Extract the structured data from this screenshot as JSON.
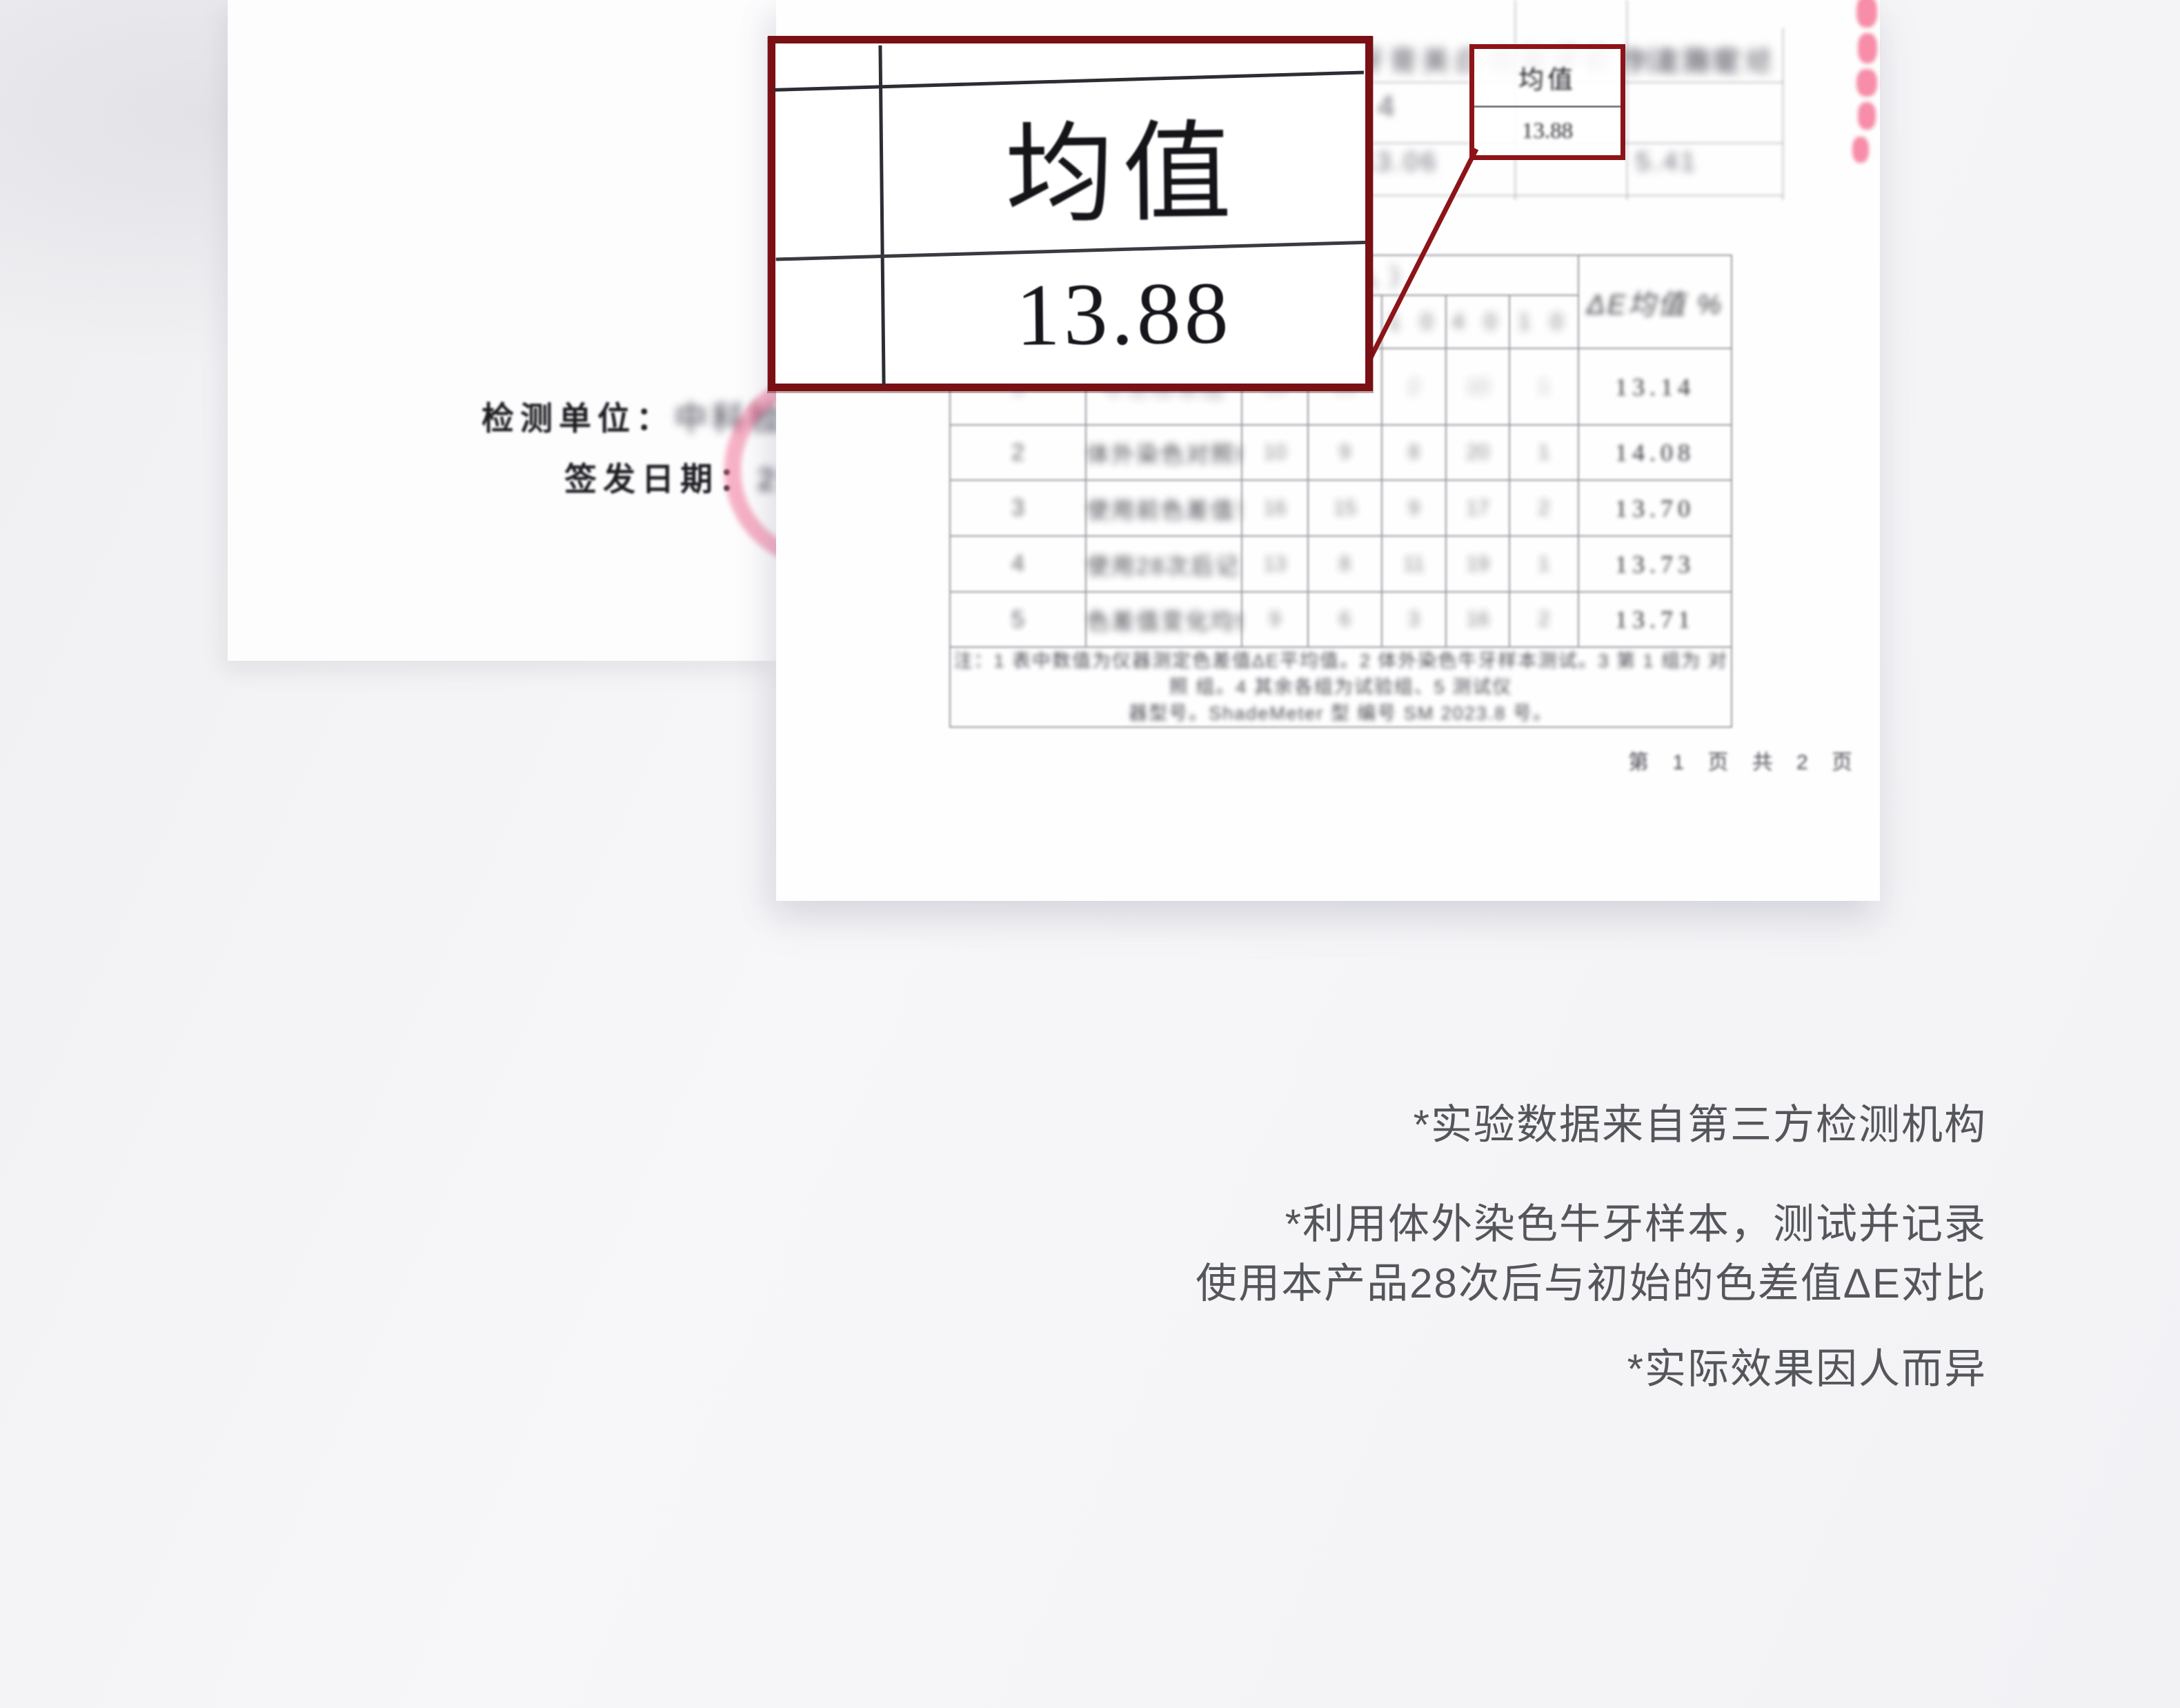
{
  "colors": {
    "accent_red": "#7a1014",
    "stamp_pink": "#f78da8",
    "disclaimer_text": "#54565b"
  },
  "callout": {
    "label": "均值",
    "value": "13.88",
    "mini": {
      "label": "均值",
      "value": "13.88"
    }
  },
  "back_paper": {
    "line1_label": "检测单位：",
    "line1_value": "中科检测",
    "line2_label": "签发日期：",
    "line2_value": "2023"
  },
  "report": {
    "title_blur": "依据企业标准牙膏美白功效评价方法测定结果 3.2",
    "ghost": {
      "cell_a": "4",
      "cell_b": "13.06",
      "header": "判定指标",
      "cell_c": "5.41"
    },
    "table": {
      "group_header": "测试数据（测试人）",
      "sub_headers": [
        "3 0",
        "1 0",
        "4 0",
        "1 0"
      ],
      "right_header": "ΔE均值 %",
      "rows": [
        {
          "cells": [
            "1",
            "牛牙样本组",
            "13",
            "13",
            "2",
            "10",
            "1",
            "13.14"
          ]
        },
        {
          "cells": [
            "2",
            "体外染色对照组",
            "10",
            "9",
            "8",
            "20",
            "1",
            "14.08"
          ]
        },
        {
          "cells": [
            "3",
            "使用前色差值记录",
            "16",
            "15",
            "9",
            "17",
            "2",
            "13.70"
          ]
        },
        {
          "cells": [
            "4",
            "使用28次后记录",
            "13",
            "8",
            "11",
            "19",
            "1",
            "13.73"
          ]
        },
        {
          "cells": [
            "5",
            "色差值变化均值",
            "9",
            "6",
            "3",
            "16",
            "2",
            "13.71"
          ]
        }
      ],
      "footnote_line1": "注：1 表中数值为仪器测定色差值ΔE平均值。2 体外染色牛牙样本测试。3 第 1 组为 对照 组。4 其余各组为试验组、5 测试仪",
      "footnote_line2": "器型号。ShadeMeter 型 编号 SM 2023.8 号。"
    },
    "page_footer": "第 1 页 共 2 页"
  },
  "disclaimers": [
    "*实验数据来自第三方检测机构",
    "*利用体外染色牛牙样本，测试并记录",
    "使用本产品28次后与初始的色差值ΔE对比",
    "*实际效果因人而异"
  ]
}
